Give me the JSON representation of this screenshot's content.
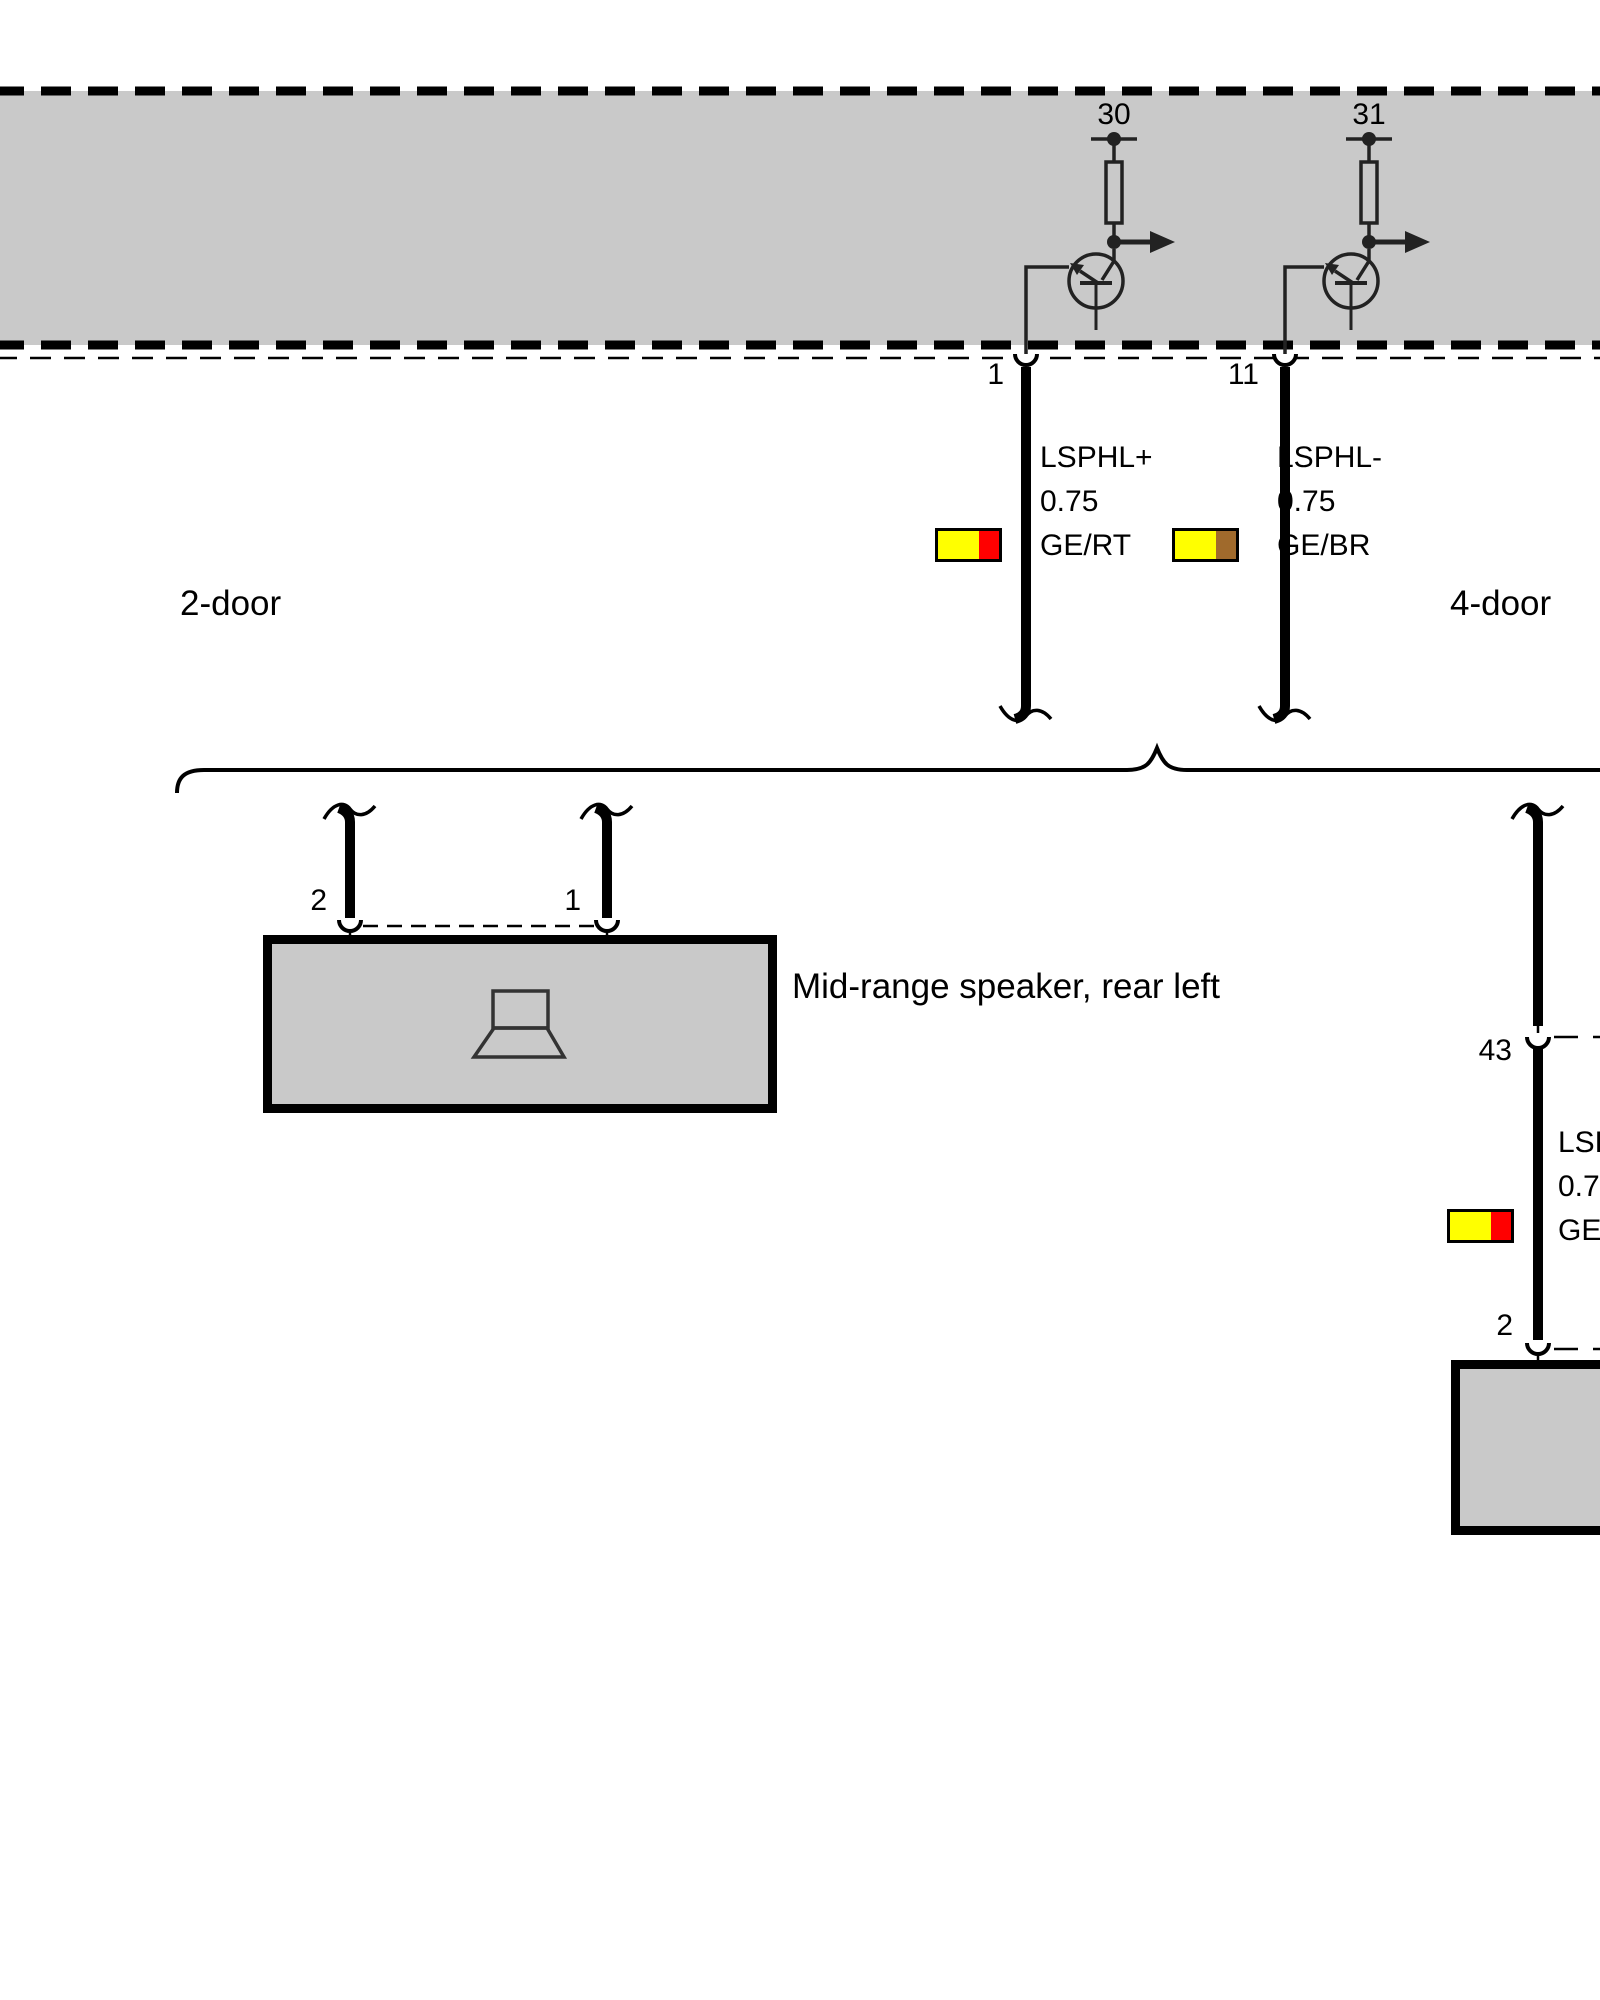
{
  "variant_labels": {
    "left": "2-door",
    "right": "4-door"
  },
  "control_unit": {
    "terminals": [
      {
        "id": "30"
      },
      {
        "id": "31"
      }
    ]
  },
  "pins": {
    "amp_left": "1",
    "amp_right": "11",
    "speaker_left": "2",
    "speaker_right": "1",
    "branch_connector": "43",
    "right_speaker": "2"
  },
  "wires": [
    {
      "signal": "LSPHL+",
      "gauge": "0.75",
      "code": "GE/RT",
      "swatch": [
        "#ffff00",
        "#ff0000"
      ]
    },
    {
      "signal": "LSPHL-",
      "gauge": "0.75",
      "code": "GE/BR",
      "swatch": [
        "#ffff00",
        "#a06a2c"
      ]
    },
    {
      "signal": "LSP",
      "gauge": "0.75",
      "code": "GE/",
      "swatch": [
        "#ffff00",
        "#ff0000"
      ]
    }
  ],
  "components": {
    "speaker_label": "Mid-range speaker, rear left"
  },
  "colors": {
    "unit_fill": "#c9c9c9",
    "wire": "#000000",
    "circuit": "#222222",
    "yellow": "#ffff00",
    "red": "#ff0000",
    "brown": "#a06a2c"
  }
}
